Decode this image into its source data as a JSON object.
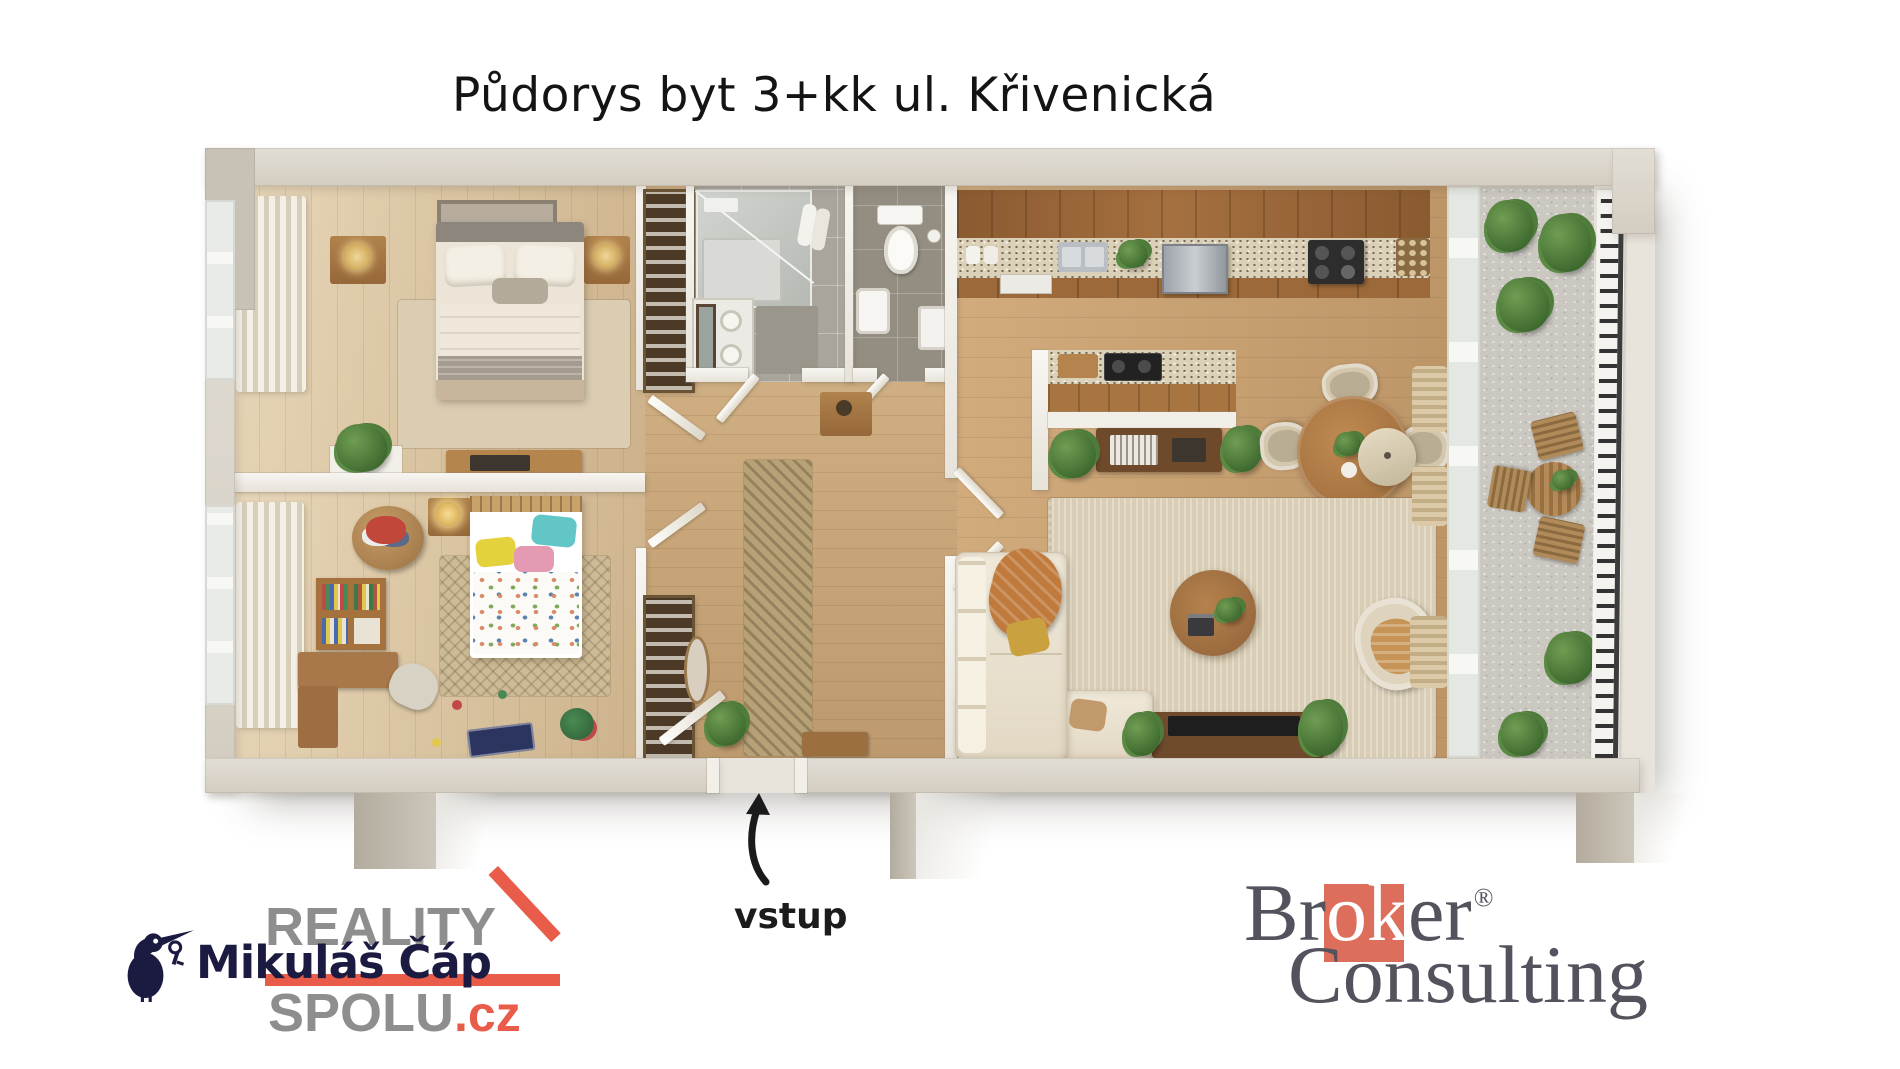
{
  "title": "Půdorys byt 3+kk ul. Křivenická",
  "entrance": {
    "label": "vstup",
    "arrow_icon": "curved-up-arrow-icon"
  },
  "branding": {
    "agent": {
      "name": "Mikuláš Čáp",
      "icon": "stork-with-key-icon",
      "navy": "#1b1b42"
    },
    "reality_spolu": {
      "word1": "REALITY",
      "word2": "SPOLU",
      "tld": ".cz",
      "gray": "#8e8e8e",
      "red": "#e85c49"
    },
    "broker_consulting": {
      "pre": "Br",
      "mid": "ok",
      "post": "er",
      "registered": "®",
      "line2": "Consulting",
      "gray": "#54535d",
      "red": "#dd6e5c"
    }
  }
}
